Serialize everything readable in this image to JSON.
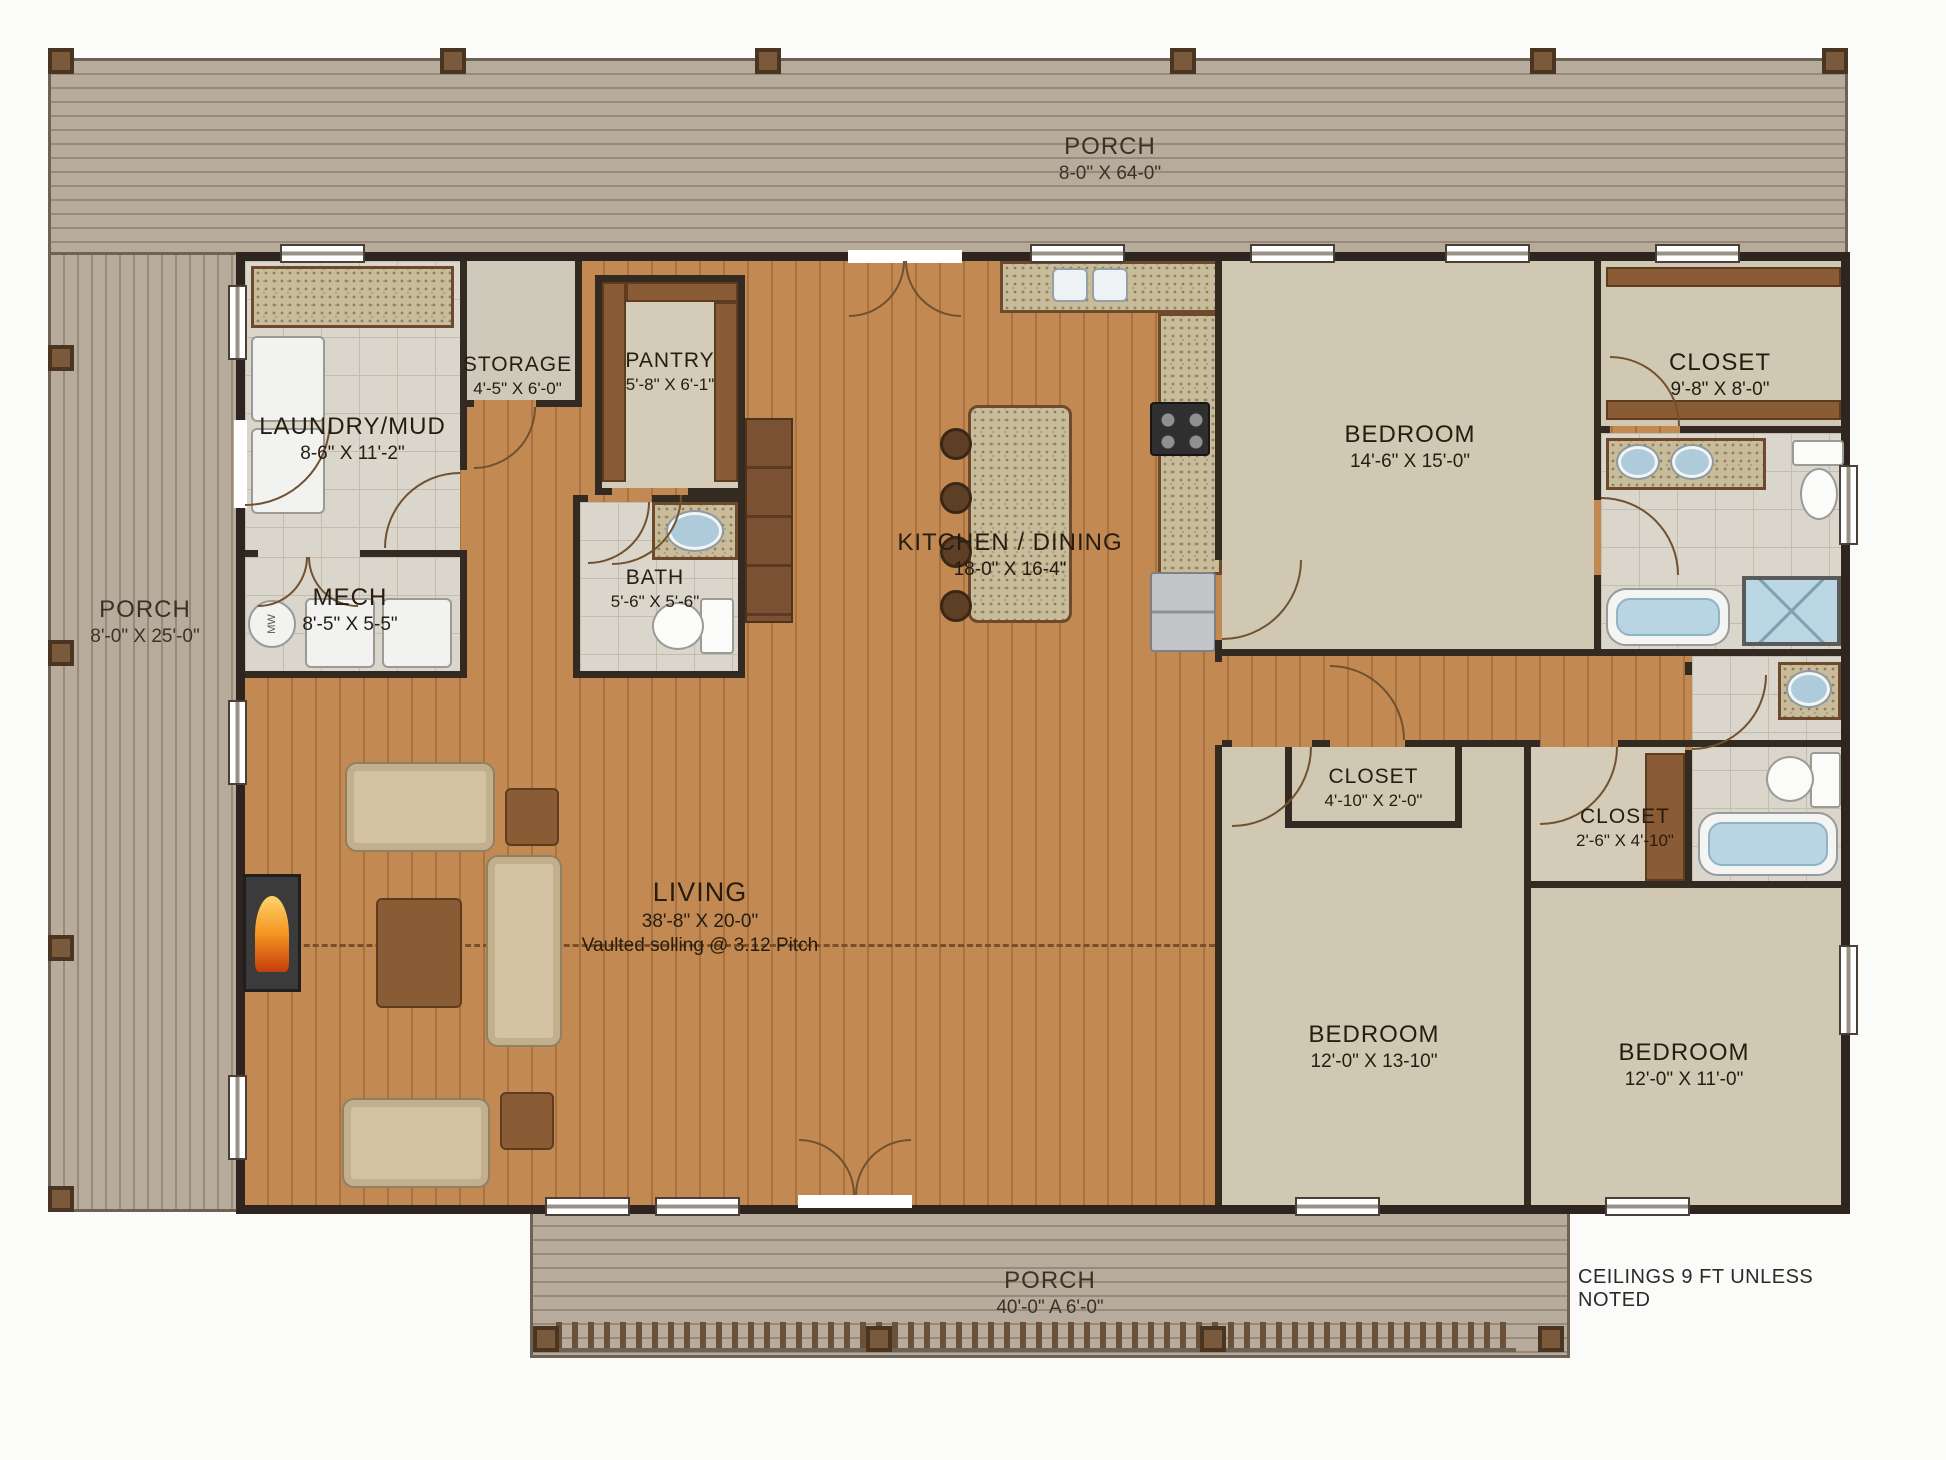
{
  "plan": {
    "note": "CEILINGS 9 FT UNLESS NOTED",
    "appliance_label": "MW",
    "rooms": {
      "porch_top": {
        "name": "PORCH",
        "dims": "8-0\" X 64-0\""
      },
      "porch_left": {
        "name": "PORCH",
        "dims": "8'-0\" X 25'-0\""
      },
      "porch_bottom": {
        "name": "PORCH",
        "dims": "40'-0\" A 6'-0\""
      },
      "laundry": {
        "name": "LAUNDRY/MUD",
        "dims": "8-6\" X 11'-2\""
      },
      "storage": {
        "name": "STORAGE",
        "dims": "4'-5\" X 6'-0\""
      },
      "pantry": {
        "name": "PANTRY",
        "dims": "5'-8\" X 6'-1\""
      },
      "mech": {
        "name": "MECH",
        "dims": "8'-5\" X 5-5\""
      },
      "bath": {
        "name": "BATH",
        "dims": "5'-6\" X 5'-6\""
      },
      "kitchen": {
        "name": "KITCHEN / DINING",
        "dims": "18-0\" X 16-4\""
      },
      "bedroom_master": {
        "name": "BEDROOM",
        "dims": "14'-6\" X 15'-0\""
      },
      "closet_master": {
        "name": "CLOSET",
        "dims": "9'-8\" X 8'-0\""
      },
      "living": {
        "name": "LIVING",
        "dims": "38'-8\" X 20-0\"",
        "note": "Vaulted solling @ 3.12 Pitch"
      },
      "closet_hall": {
        "name": "CLOSET",
        "dims": "4'-10\" X 2'-0\""
      },
      "closet_bed3": {
        "name": "CLOSET",
        "dims": "2'-6\" X 4'-10\""
      },
      "bedroom_mid": {
        "name": "BEDROOM",
        "dims": "12'-0\" X 13-10\""
      },
      "bedroom_right": {
        "name": "BEDROOM",
        "dims": "12'-0\" X 11'-0\""
      }
    },
    "colors": {
      "wood_floor": "#c28a52",
      "wall": "#332a22",
      "porch_deck": "#b7ab9c",
      "carpet": "#d0c8b2",
      "tile": "#dad6cb",
      "water_fixture": "#b9d4e2",
      "granite": "#c9bc9b"
    }
  }
}
